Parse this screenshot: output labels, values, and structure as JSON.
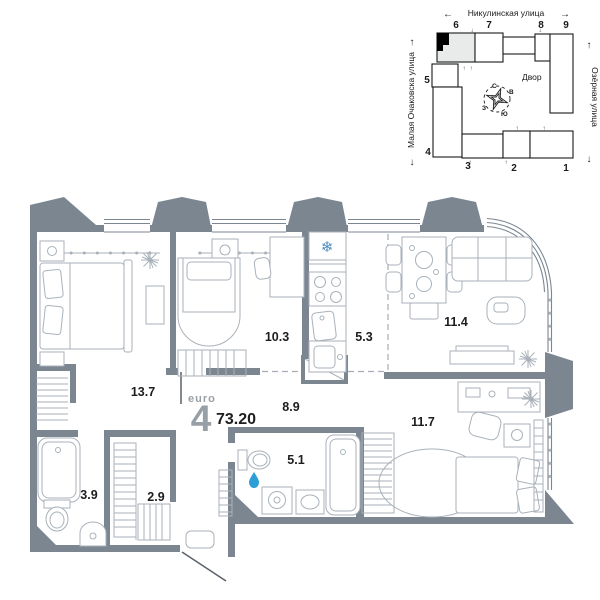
{
  "floor_plan": {
    "unit": {
      "type_label": "euro",
      "rooms_count": "4",
      "total_area": "73.20"
    },
    "rooms": [
      {
        "id": "bedroom-1",
        "area": "13.7"
      },
      {
        "id": "bedroom-2",
        "area": "10.3"
      },
      {
        "id": "kitchen",
        "area": "5.3"
      },
      {
        "id": "living-room",
        "area": "11.4"
      },
      {
        "id": "hallway",
        "area": "8.9"
      },
      {
        "id": "bedroom-3",
        "area": "11.7"
      },
      {
        "id": "bathroom-1",
        "area": "3.9"
      },
      {
        "id": "wardrobe",
        "area": "2.9"
      },
      {
        "id": "bathroom-2",
        "area": "5.1"
      }
    ],
    "icons": {
      "fridge_snowflake": "❄",
      "water_drop": "drop-shape"
    },
    "colors": {
      "wall": "#7b8691",
      "furniture_line": "#a9b2ba",
      "label_text": "#1d1d1d",
      "muted_text": "#98a0a7",
      "accent_blue": "#2d9fd6"
    }
  },
  "site_plan": {
    "streets": {
      "top": "Никулинская улица",
      "left": "Малая Очаковска улица",
      "right": "Озёрная улица"
    },
    "courtyard": "Двор",
    "compass": {
      "n": "С",
      "e": "В",
      "s": "Ю",
      "w": "З"
    },
    "building_numbers": [
      "1",
      "2",
      "3",
      "4",
      "5",
      "6",
      "7",
      "8",
      "9"
    ],
    "arrows": {
      "left": "←",
      "right": "→",
      "up": "↑",
      "down": "↓"
    },
    "entrance_marks": {
      "up": "↑",
      "down": "↓"
    }
  }
}
